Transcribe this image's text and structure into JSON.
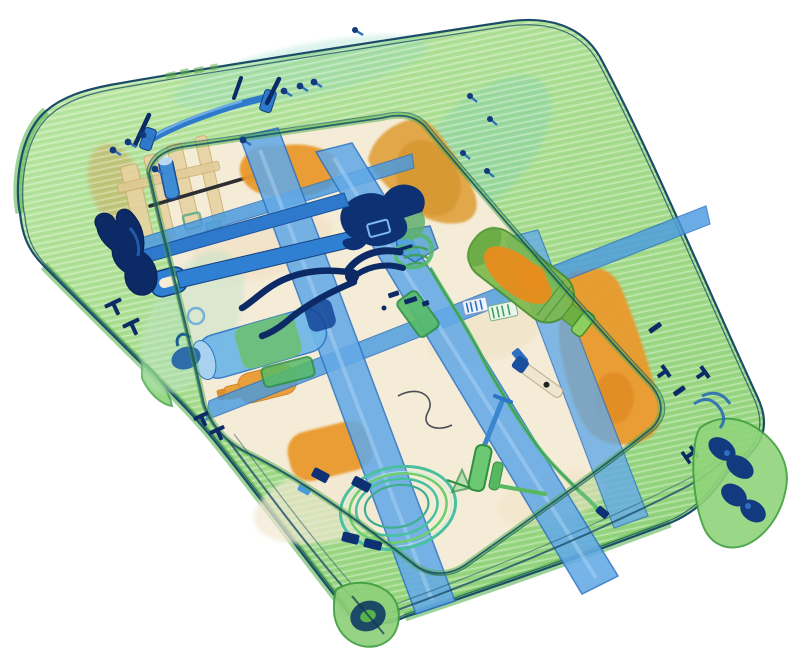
{
  "scene": {
    "type": "x-ray-baggage-scan",
    "description": "Security X-ray scan of a tilted hard-shell rolling suitcase packed with tools: claw hammer, adjustable wrench, pliers, spray head with hose, hand pump, coiled cable, bottle of liquid, packing straps, clothing bundles and spinner wheels",
    "background_color": "#ffffff"
  },
  "palette": {
    "shell_green": "#aedf92",
    "shell_green_light": "#c8ecae",
    "shell_green_dark": "#4cae45",
    "shell_green_deep": "#2f9a3e",
    "shell_teal": "#8fd8c4",
    "outline_navy": "#1b4d68",
    "interior_beige": "#f5ecd7",
    "interior_warm": "#f0e2c6",
    "organic_orange": "#e9992d",
    "organic_orange_tan": "#dfa13c",
    "organic_orange_deep": "#dd831d",
    "strap_blue": "#63a9e6",
    "strap_blue_deep": "#4a9ae0",
    "strap_blue_edge": "#2d74c4",
    "metal_blue": "#2e79cc",
    "metal_blue_mid": "#2f80d2",
    "metal_navy": "#0e3174",
    "metal_navy_dark": "#0c2b66",
    "wire_teal": "#49c0a0",
    "wire_lime": "#6fcf6f",
    "hose_green": "#53b86a",
    "bottle_green": "#7cb94e",
    "bottle_green_edge": "#478f2e",
    "liquid_orange": "#e78c1e",
    "pump_green": "#6cc873",
    "pump_green_edge": "#2f8f3f",
    "tan_wood": "#e7d3a2",
    "tan_wood_edge": "#c9ae6f",
    "wheel_navy": "#123a7e",
    "rod_dark": "#2b2f33"
  },
  "objects": [
    {
      "id": "suitcase-shell",
      "label": "translucent hard-shell suitcase"
    },
    {
      "id": "carry-handle",
      "label": "top carry handle"
    },
    {
      "id": "claw-hammer",
      "label": "claw hammer"
    },
    {
      "id": "adjustable-wrench",
      "label": "adjustable wrench"
    },
    {
      "id": "pliers",
      "label": "pliers"
    },
    {
      "id": "spray-head",
      "label": "spray head with green hose"
    },
    {
      "id": "hand-pump",
      "label": "hand pump"
    },
    {
      "id": "cable-coil",
      "label": "coiled cable"
    },
    {
      "id": "liquid-bottle",
      "label": "plastic bottle with liquid"
    },
    {
      "id": "packing-straps",
      "label": "blue packing straps"
    },
    {
      "id": "clothing-bundles",
      "label": "orange organic bundles"
    },
    {
      "id": "wooden-slats",
      "label": "wooden slats"
    },
    {
      "id": "spinner-wheels",
      "label": "spinner wheels"
    },
    {
      "id": "screws",
      "label": "loose screws and pins"
    }
  ]
}
